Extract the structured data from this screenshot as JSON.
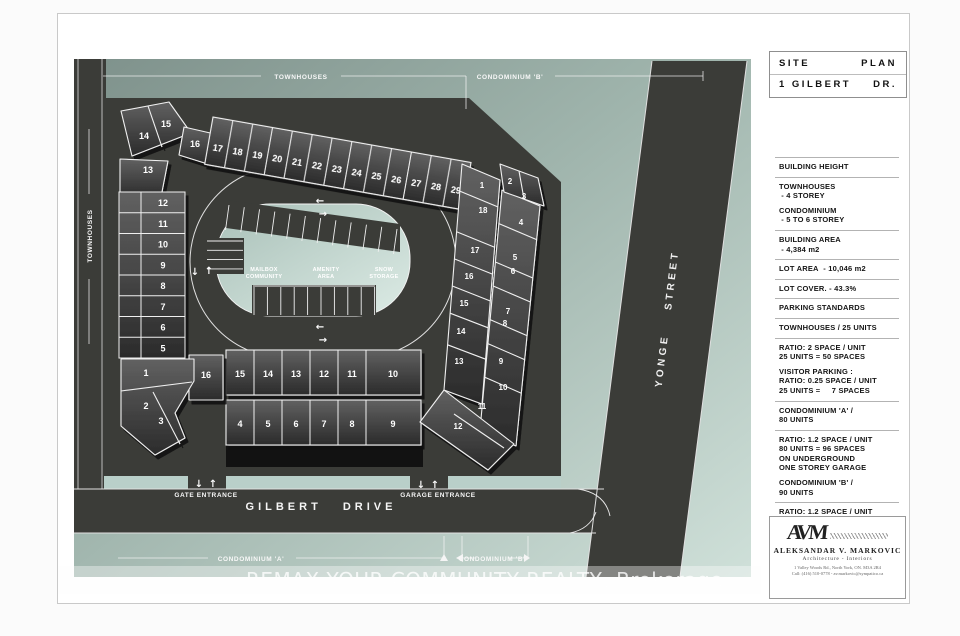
{
  "title_block": {
    "line1_left": "SITE",
    "line1_right": "PLAN",
    "line2_left": "1 GILBERT",
    "line2_right": "DR."
  },
  "info_panel": {
    "sections": [
      {
        "lines": [
          "BUILDING HEIGHT"
        ],
        "rule": true
      },
      {
        "lines": [
          "TOWNHOUSES",
          " - 4 STOREY"
        ],
        "rule": false
      },
      {
        "lines": [
          "CONDOMINIUM",
          " - 5 TO 6 STOREY"
        ],
        "rule": true
      },
      {
        "lines": [
          "BUILDING AREA",
          " - 4,384 m2"
        ],
        "rule": true
      },
      {
        "lines": [
          "LOT AREA  - 10,046 m2"
        ],
        "rule": true
      },
      {
        "lines": [
          "LOT COVER. - 43.3%"
        ],
        "rule": true
      },
      {
        "lines": [
          "PARKING STANDARDS"
        ],
        "rule": true
      },
      {
        "lines": [
          "TOWNHOUSES / 25 UNITS"
        ],
        "rule": true
      },
      {
        "lines": [
          "RATIO: 2 SPACE / UNIT",
          "25 UNITS = 50 SPACES"
        ],
        "rule": false
      },
      {
        "lines": [
          "VISITOR PARKING :",
          "RATIO: 0.25 SPACE / UNIT",
          "25 UNITS =     7 SPACES"
        ],
        "rule": true
      },
      {
        "lines": [
          "CONDOMINIUM 'A' /",
          "80 UNITS"
        ],
        "rule": true
      },
      {
        "lines": [
          "RATIO: 1.2 SPACE / UNIT",
          "80 UNITS = 96 SPACES",
          "ON UNDERGROUND",
          "ONE STOREY GARAGE"
        ],
        "rule": false
      },
      {
        "lines": [
          "CONDOMINIUM 'B' /",
          "90 UNITS"
        ],
        "rule": true
      },
      {
        "lines": [
          "RATIO: 1.2 SPACE / UNIT",
          "90 UNITS = 108 SPACES",
          "ON UNDERGROUND",
          "ONE STOREY GARAGE"
        ],
        "rule": false
      }
    ]
  },
  "logo_block": {
    "monogram": "AVM",
    "name": "ALEKSANDAR  V.  MARKOVIC",
    "subtitle": "Architecture  -  Interiors",
    "address": "1 Valley Woods Rd., North York, ON.  M3A 2R4",
    "contact": "Call: (416) 510-0778  -  av.markovic@sympatico.ca"
  },
  "map": {
    "street_labels": {
      "yonge": "YONGE STREET",
      "gilbert": "GILBERT DRIVE",
      "townhouses_left": "TOWNHOUSES"
    },
    "area_labels": {
      "townhouses_top": "TOWNHOUSES",
      "condo_b_top": "CONDOMINIUM 'B'",
      "condo_a_bottom": "CONDOMINIUM 'A'",
      "condo_b_bottom": "CONDOMINIUM 'B'",
      "gate": "GATE ENTRANCE",
      "garage": "GARAGE ENTRANCE"
    },
    "island_labels": [
      [
        "MAILBOX",
        "COMMUNITY"
      ],
      [
        "AMENITY",
        "AREA"
      ],
      [
        "SNOW",
        "STORAGE"
      ]
    ],
    "units": {
      "corner_fan": [
        "14",
        "15",
        "16",
        "13"
      ],
      "top_row": [
        "17",
        "18",
        "19",
        "20",
        "21",
        "22",
        "23",
        "24",
        "25",
        "26",
        "27",
        "28",
        "29"
      ],
      "left_column": [
        "12",
        "11",
        "10",
        "9",
        "8",
        "7",
        "6",
        "5"
      ],
      "mid_upper": [
        "15",
        "14",
        "13",
        "12",
        "11",
        "10"
      ],
      "mid_lower": [
        "4",
        "5",
        "6",
        "7",
        "8",
        "9"
      ],
      "mid_left": [
        "16",
        "1",
        "2",
        "3"
      ],
      "condo_b_inner": [
        "1",
        "18",
        "17",
        "16",
        "15",
        "14",
        "13"
      ],
      "condo_b_outer": [
        "2",
        "3",
        "4",
        "5",
        "6",
        "7",
        "8",
        "9",
        "10",
        "11",
        "12"
      ]
    },
    "arrows": [
      "←",
      "→",
      "↑",
      "↓"
    ]
  },
  "watermark": "REMAX YOUR COMMUNITY REALTY, Brokerage",
  "colors": {
    "site_green_dark": "#7e918b",
    "site_green_light": "#cfe0d9",
    "road": "#3b3c38",
    "building_dark": "#2b2b2b",
    "building_light": "#5f5f5f",
    "island_light": "#dcebe5",
    "sidewalk": "#b9cfc9",
    "line_white": "#f2f2f2"
  }
}
